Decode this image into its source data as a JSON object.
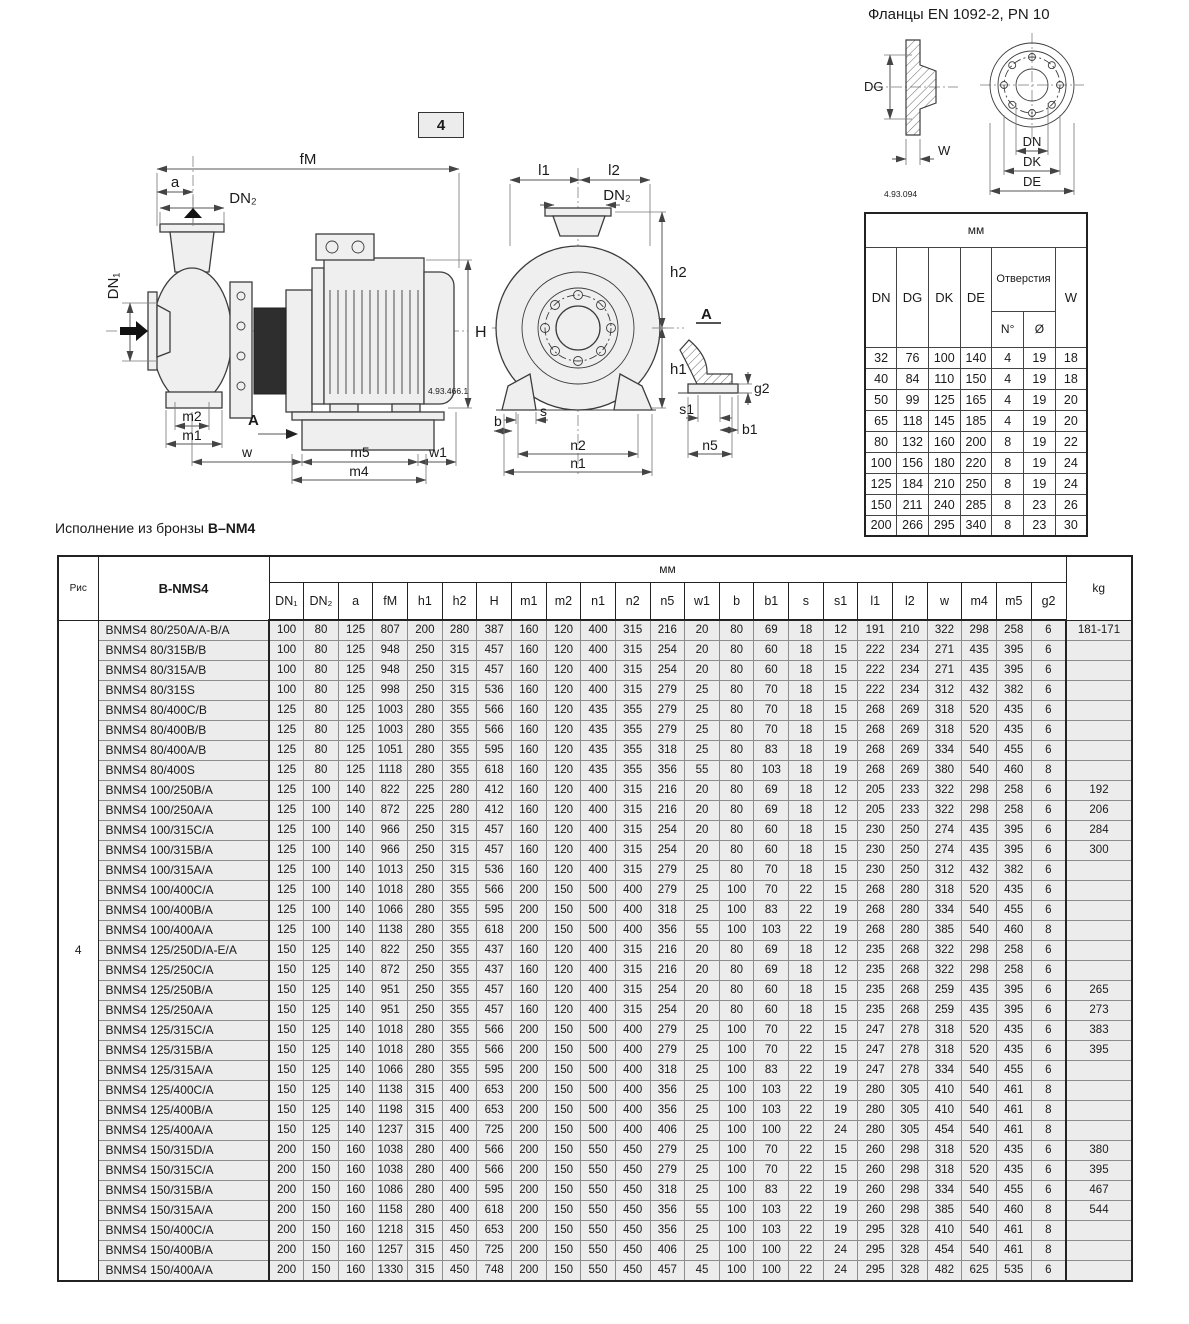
{
  "flange": {
    "title": "Фланцы EN 1092-2, PN 10",
    "ref": "4.93.094",
    "labels": {
      "dg": "DG",
      "w": "W",
      "dn": "DN",
      "dk": "DK",
      "de": "DE"
    },
    "table": {
      "unit": "мм",
      "col_dn": "DN",
      "col_dg": "DG",
      "col_dk": "DK",
      "col_de": "DE",
      "holes": "Отверстия",
      "holes_n": "N°",
      "holes_d": "Ø",
      "col_w": "W",
      "rows": [
        [
          32,
          76,
          100,
          140,
          4,
          19,
          18
        ],
        [
          40,
          84,
          110,
          150,
          4,
          19,
          18
        ],
        [
          50,
          99,
          125,
          165,
          4,
          19,
          20
        ],
        [
          65,
          118,
          145,
          185,
          4,
          19,
          20
        ],
        [
          80,
          132,
          160,
          200,
          8,
          19,
          22
        ],
        [
          100,
          156,
          180,
          220,
          8,
          19,
          24
        ],
        [
          125,
          184,
          210,
          250,
          8,
          19,
          24
        ],
        [
          150,
          211,
          240,
          285,
          8,
          23,
          26
        ],
        [
          200,
          266,
          295,
          340,
          8,
          23,
          30
        ]
      ]
    }
  },
  "figure": {
    "number": "4",
    "ref": "4.93.466.1",
    "side": {
      "fm": "fM",
      "a": "a",
      "dn2": "DN₂",
      "dn1": "DN₁",
      "h": "H",
      "m2": "m2",
      "m1": "m1",
      "a_label": "A",
      "w": "w",
      "m5": "m5",
      "w1": "w1",
      "m4": "m4"
    },
    "front": {
      "l1": "l1",
      "l2": "l2",
      "dn2": "DN₂",
      "h2": "h2",
      "h1": "h1",
      "a_label": "A",
      "g2": "g2",
      "s": "s",
      "b": "b",
      "s1": "s1",
      "b1": "b1",
      "n2": "n2",
      "n5": "n5",
      "n1": "n1"
    }
  },
  "bronze": {
    "prefix": "Исполнение из бронзы ",
    "model": "B–NM4"
  },
  "main_table": {
    "fig_header": "Рис",
    "fig_value": "4",
    "model_header": "B-NMS4",
    "unit_header": "мм",
    "kg_header": "kg",
    "columns": [
      "DN₁",
      "DN₂",
      "a",
      "fM",
      "h1",
      "h2",
      "H",
      "m1",
      "m2",
      "n1",
      "n2",
      "n5",
      "w1",
      "b",
      "b1",
      "s",
      "s1",
      "l1",
      "l2",
      "w",
      "m4",
      "m5",
      "g2"
    ],
    "rows": [
      {
        "name": "BNMS4 80/250A/A-B/A",
        "values": [
          100,
          80,
          125,
          807,
          200,
          280,
          387,
          160,
          120,
          400,
          315,
          216,
          20,
          80,
          69,
          18,
          12,
          191,
          210,
          322,
          298,
          258,
          6
        ],
        "kg": "181-171"
      },
      {
        "name": "BNMS4 80/315B/B",
        "values": [
          100,
          80,
          125,
          948,
          250,
          315,
          457,
          160,
          120,
          400,
          315,
          254,
          20,
          80,
          60,
          18,
          15,
          222,
          234,
          271,
          435,
          395,
          6
        ],
        "kg": ""
      },
      {
        "name": "BNMS4 80/315A/B",
        "values": [
          100,
          80,
          125,
          948,
          250,
          315,
          457,
          160,
          120,
          400,
          315,
          254,
          20,
          80,
          60,
          18,
          15,
          222,
          234,
          271,
          435,
          395,
          6
        ],
        "kg": ""
      },
      {
        "name": "BNMS4 80/315S",
        "values": [
          100,
          80,
          125,
          998,
          250,
          315,
          536,
          160,
          120,
          400,
          315,
          279,
          25,
          80,
          70,
          18,
          15,
          222,
          234,
          312,
          432,
          382,
          6
        ],
        "kg": ""
      },
      {
        "name": "BNMS4 80/400C/B",
        "values": [
          125,
          80,
          125,
          1003,
          280,
          355,
          566,
          160,
          120,
          435,
          355,
          279,
          25,
          80,
          70,
          18,
          15,
          268,
          269,
          318,
          520,
          435,
          6
        ],
        "kg": ""
      },
      {
        "name": "BNMS4 80/400B/B",
        "values": [
          125,
          80,
          125,
          1003,
          280,
          355,
          566,
          160,
          120,
          435,
          355,
          279,
          25,
          80,
          70,
          18,
          15,
          268,
          269,
          318,
          520,
          435,
          6
        ],
        "kg": ""
      },
      {
        "name": "BNMS4 80/400A/B",
        "values": [
          125,
          80,
          125,
          1051,
          280,
          355,
          595,
          160,
          120,
          435,
          355,
          318,
          25,
          80,
          83,
          18,
          19,
          268,
          269,
          334,
          540,
          455,
          6
        ],
        "kg": ""
      },
      {
        "name": "BNMS4 80/400S",
        "values": [
          125,
          80,
          125,
          1118,
          280,
          355,
          618,
          160,
          120,
          435,
          355,
          356,
          55,
          80,
          103,
          18,
          19,
          268,
          269,
          380,
          540,
          460,
          8
        ],
        "kg": ""
      },
      {
        "name": "BNMS4 100/250B/A",
        "values": [
          125,
          100,
          140,
          822,
          225,
          280,
          412,
          160,
          120,
          400,
          315,
          216,
          20,
          80,
          69,
          18,
          12,
          205,
          233,
          322,
          298,
          258,
          6
        ],
        "kg": "192"
      },
      {
        "name": "BNMS4 100/250A/A",
        "values": [
          125,
          100,
          140,
          872,
          225,
          280,
          412,
          160,
          120,
          400,
          315,
          216,
          20,
          80,
          69,
          18,
          12,
          205,
          233,
          322,
          298,
          258,
          6
        ],
        "kg": "206"
      },
      {
        "name": "BNMS4 100/315C/A",
        "values": [
          125,
          100,
          140,
          966,
          250,
          315,
          457,
          160,
          120,
          400,
          315,
          254,
          20,
          80,
          60,
          18,
          15,
          230,
          250,
          274,
          435,
          395,
          6
        ],
        "kg": "284"
      },
      {
        "name": "BNMS4 100/315B/A",
        "values": [
          125,
          100,
          140,
          966,
          250,
          315,
          457,
          160,
          120,
          400,
          315,
          254,
          20,
          80,
          60,
          18,
          15,
          230,
          250,
          274,
          435,
          395,
          6
        ],
        "kg": "300"
      },
      {
        "name": "BNMS4 100/315A/A",
        "values": [
          125,
          100,
          140,
          1013,
          250,
          315,
          536,
          160,
          120,
          400,
          315,
          279,
          25,
          80,
          70,
          18,
          15,
          230,
          250,
          312,
          432,
          382,
          6
        ],
        "kg": ""
      },
      {
        "name": "BNMS4 100/400C/A",
        "values": [
          125,
          100,
          140,
          1018,
          280,
          355,
          566,
          200,
          150,
          500,
          400,
          279,
          25,
          100,
          70,
          22,
          15,
          268,
          280,
          318,
          520,
          435,
          6
        ],
        "kg": ""
      },
      {
        "name": "BNMS4 100/400B/A",
        "values": [
          125,
          100,
          140,
          1066,
          280,
          355,
          595,
          200,
          150,
          500,
          400,
          318,
          25,
          100,
          83,
          22,
          19,
          268,
          280,
          334,
          540,
          455,
          6
        ],
        "kg": ""
      },
      {
        "name": "BNMS4 100/400A/A",
        "values": [
          125,
          100,
          140,
          1138,
          280,
          355,
          618,
          200,
          150,
          500,
          400,
          356,
          55,
          100,
          103,
          22,
          19,
          268,
          280,
          385,
          540,
          460,
          8
        ],
        "kg": ""
      },
      {
        "name": "BNMS4 125/250D/A-E/A",
        "values": [
          150,
          125,
          140,
          822,
          250,
          355,
          437,
          160,
          120,
          400,
          315,
          216,
          20,
          80,
          69,
          18,
          12,
          235,
          268,
          322,
          298,
          258,
          6
        ],
        "kg": ""
      },
      {
        "name": "BNMS4 125/250C/A",
        "values": [
          150,
          125,
          140,
          872,
          250,
          355,
          437,
          160,
          120,
          400,
          315,
          216,
          20,
          80,
          69,
          18,
          12,
          235,
          268,
          322,
          298,
          258,
          6
        ],
        "kg": ""
      },
      {
        "name": "BNMS4 125/250B/A",
        "values": [
          150,
          125,
          140,
          951,
          250,
          355,
          457,
          160,
          120,
          400,
          315,
          254,
          20,
          80,
          60,
          18,
          15,
          235,
          268,
          259,
          435,
          395,
          6
        ],
        "kg": "265"
      },
      {
        "name": "BNMS4 125/250A/A",
        "values": [
          150,
          125,
          140,
          951,
          250,
          355,
          457,
          160,
          120,
          400,
          315,
          254,
          20,
          80,
          60,
          18,
          15,
          235,
          268,
          259,
          435,
          395,
          6
        ],
        "kg": "273"
      },
      {
        "name": "BNMS4 125/315C/A",
        "values": [
          150,
          125,
          140,
          1018,
          280,
          355,
          566,
          200,
          150,
          500,
          400,
          279,
          25,
          100,
          70,
          22,
          15,
          247,
          278,
          318,
          520,
          435,
          6
        ],
        "kg": "383"
      },
      {
        "name": "BNMS4 125/315B/A",
        "values": [
          150,
          125,
          140,
          1018,
          280,
          355,
          566,
          200,
          150,
          500,
          400,
          279,
          25,
          100,
          70,
          22,
          15,
          247,
          278,
          318,
          520,
          435,
          6
        ],
        "kg": "395"
      },
      {
        "name": "BNMS4 125/315A/A",
        "values": [
          150,
          125,
          140,
          1066,
          280,
          355,
          595,
          200,
          150,
          500,
          400,
          318,
          25,
          100,
          83,
          22,
          19,
          247,
          278,
          334,
          540,
          455,
          6
        ],
        "kg": ""
      },
      {
        "name": "BNMS4 125/400C/A",
        "values": [
          150,
          125,
          140,
          1138,
          315,
          400,
          653,
          200,
          150,
          500,
          400,
          356,
          25,
          100,
          103,
          22,
          19,
          280,
          305,
          410,
          540,
          461,
          8
        ],
        "kg": ""
      },
      {
        "name": "BNMS4 125/400B/A",
        "values": [
          150,
          125,
          140,
          1198,
          315,
          400,
          653,
          200,
          150,
          500,
          400,
          356,
          25,
          100,
          103,
          22,
          19,
          280,
          305,
          410,
          540,
          461,
          8
        ],
        "kg": ""
      },
      {
        "name": "BNMS4 125/400A/A",
        "values": [
          150,
          125,
          140,
          1237,
          315,
          400,
          725,
          200,
          150,
          500,
          400,
          406,
          25,
          100,
          100,
          22,
          24,
          280,
          305,
          454,
          540,
          461,
          8
        ],
        "kg": ""
      },
      {
        "name": "BNMS4 150/315D/A",
        "values": [
          200,
          150,
          160,
          1038,
          280,
          400,
          566,
          200,
          150,
          550,
          450,
          279,
          25,
          100,
          70,
          22,
          15,
          260,
          298,
          318,
          520,
          435,
          6
        ],
        "kg": "380"
      },
      {
        "name": "BNMS4 150/315C/A",
        "values": [
          200,
          150,
          160,
          1038,
          280,
          400,
          566,
          200,
          150,
          550,
          450,
          279,
          25,
          100,
          70,
          22,
          15,
          260,
          298,
          318,
          520,
          435,
          6
        ],
        "kg": "395"
      },
      {
        "name": "BNMS4 150/315B/A",
        "values": [
          200,
          150,
          160,
          1086,
          280,
          400,
          595,
          200,
          150,
          550,
          450,
          318,
          25,
          100,
          83,
          22,
          19,
          260,
          298,
          334,
          540,
          455,
          6
        ],
        "kg": "467"
      },
      {
        "name": "BNMS4 150/315A/A",
        "values": [
          200,
          150,
          160,
          1158,
          280,
          400,
          618,
          200,
          150,
          550,
          450,
          356,
          55,
          100,
          103,
          22,
          19,
          260,
          298,
          385,
          540,
          460,
          8
        ],
        "kg": "544"
      },
      {
        "name": "BNMS4 150/400C/A",
        "values": [
          200,
          150,
          160,
          1218,
          315,
          450,
          653,
          200,
          150,
          550,
          450,
          356,
          25,
          100,
          103,
          22,
          19,
          295,
          328,
          410,
          540,
          461,
          8
        ],
        "kg": ""
      },
      {
        "name": "BNMS4 150/400B/A",
        "values": [
          200,
          150,
          160,
          1257,
          315,
          450,
          725,
          200,
          150,
          550,
          450,
          406,
          25,
          100,
          100,
          22,
          24,
          295,
          328,
          454,
          540,
          461,
          8
        ],
        "kg": ""
      },
      {
        "name": "BNMS4 150/400A/A",
        "values": [
          200,
          150,
          160,
          1330,
          315,
          450,
          748,
          200,
          150,
          550,
          450,
          457,
          45,
          100,
          100,
          22,
          24,
          295,
          328,
          482,
          625,
          535,
          6
        ],
        "kg": ""
      }
    ]
  }
}
